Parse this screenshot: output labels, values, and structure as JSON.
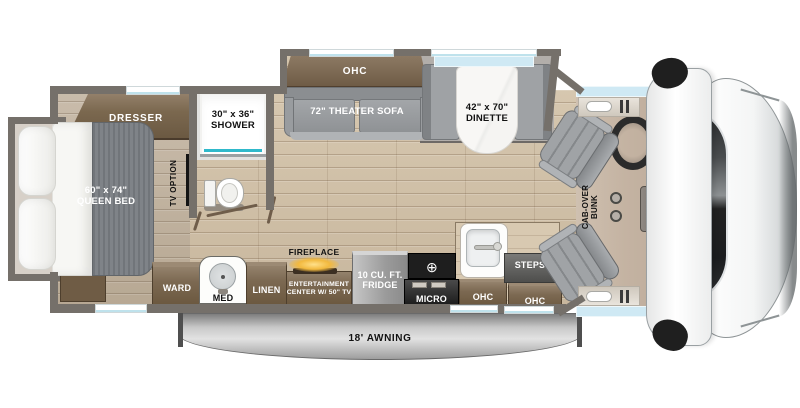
{
  "rooms": {
    "bedroom": {
      "dresser": "DRESSER",
      "bed_size": "60\" x 74\"",
      "bed_name": "QUEEN BED",
      "tv_option": "TV OPTION",
      "ward": "WARD",
      "med": "MED"
    },
    "bath": {
      "shower_size": "30\" x 36\"",
      "shower": "SHOWER"
    },
    "living": {
      "ohc": "OHC",
      "sofa": "72\" THEATER SOFA",
      "dinette_size": "42\" x 70\"",
      "dinette": "DINETTE",
      "linen": "LINEN",
      "fireplace": "FIREPLACE",
      "ent1": "ENTERTAINMENT",
      "ent2": "CENTER W/ 50\" TV"
    },
    "kitchen": {
      "fridge1": "10 CU. FT.",
      "fridge2": "FRIDGE",
      "cooktop_symbol": "⊕",
      "micro": "MICRO",
      "ohc_mid": "OHC",
      "steps": "STEPS",
      "ohc_right": "OHC"
    },
    "cab": {
      "bunk1": "CAB-OVER",
      "bunk2": "BUNK"
    },
    "exterior": {
      "awning": "18' AWNING"
    }
  },
  "colors": {
    "wall": "#75706a",
    "wood_floor": "#cfbfa7",
    "bedroom_floor": "#c1b3a1",
    "cab_floor": "#c9b9a9",
    "cabinet_brown": "#7c6952",
    "slide_gray": "#b2aeaa",
    "upholstery_gray": "#9aa0a4",
    "window_blue": "#cfe9f4",
    "shower_teal": "#2fb9cb",
    "fireplace_glow": "#f2b93e",
    "shifter_blue": "#1173d4",
    "awning_gray": "#c9c9c9",
    "vehicle_white": "#f5f6f6",
    "windshield_dark": "#1c1e20"
  }
}
